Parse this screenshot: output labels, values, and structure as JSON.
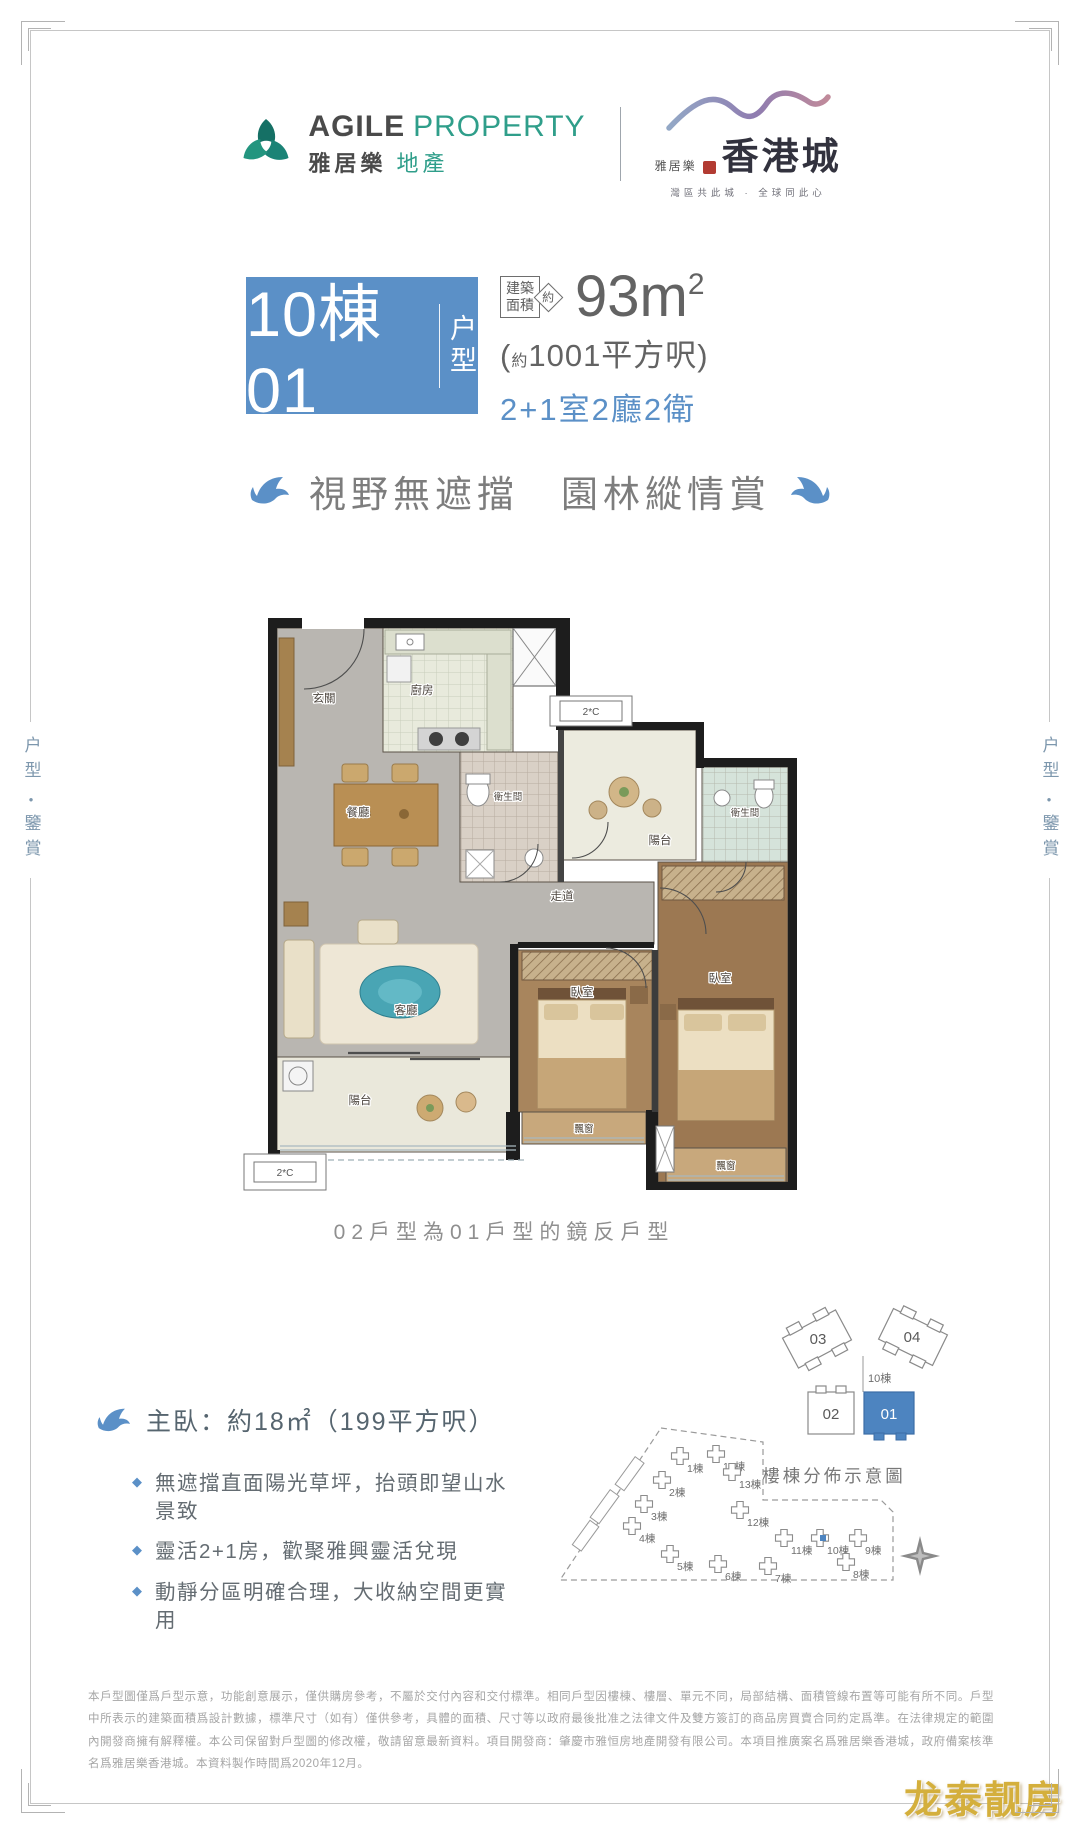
{
  "header": {
    "agile": {
      "en_bold": "AGILE",
      "en_light": "PROPERTY",
      "cn_bold": "雅居樂",
      "cn_light": "地產"
    },
    "hkcity": {
      "brand_prefix": "雅居樂",
      "brand_main": "香港城",
      "slogan": "灣區共此城 · 全球同此心"
    }
  },
  "side_label": {
    "top": "户型",
    "separator": "●",
    "bottom": "鑒賞"
  },
  "title_block": {
    "unit_number": "10棟01",
    "suffix_line1": "户",
    "suffix_line2": "型",
    "area_tag_line1": "建築",
    "area_tag_line2": "面積",
    "approx": "約",
    "area_value": "93m",
    "area_sup": "2",
    "area_hk_open": "(",
    "area_hk_approx": "約",
    "area_hk_value": "1001平方呎)",
    "layout": "2+1室2廳2衛",
    "accent_color": "#5b90c7"
  },
  "tagline": "視野無遮擋　園林縱情賞",
  "floor_plan": {
    "labels": {
      "entry": "玄關",
      "kitchen": "廚房",
      "dining": "餐廳",
      "living": "客廳",
      "corridor": "走道",
      "bath1": "衛生間",
      "bath2": "衛生間",
      "balcony_top": "陽台",
      "balcony_bottom": "陽台",
      "bedroom1": "臥室",
      "bedroom2": "臥室",
      "baywindow1": "飄窗",
      "baywindow2": "飄窗",
      "ac_unit": "2*C"
    },
    "mirror_note": "02戶型為01戶型的鏡反戶型"
  },
  "unit_cluster": {
    "tower_label": "10棟",
    "unit_03": "03",
    "unit_04": "04",
    "unit_02": "02",
    "unit_01": "01",
    "highlight_unit": "01",
    "highlight_color": "#4d84c0"
  },
  "features": {
    "headline": "主臥：約18㎡（199平方呎）",
    "bullet_glyph": "◆",
    "bullets": [
      "無遮擋直面陽光草坪，抬頭即望山水景致",
      "靈活2+1房，歡聚雅興靈活兌現",
      "動靜分區明確合理，大收納空間更實用"
    ]
  },
  "site_plan": {
    "title": "樓棟分佈示意圖",
    "highlight_building": "10棟",
    "buildings": [
      {
        "label": "1棟",
        "x": 212,
        "y": 40
      },
      {
        "label": "14棟",
        "x": 248,
        "y": 38
      },
      {
        "label": "2棟",
        "x": 194,
        "y": 64
      },
      {
        "label": "13棟",
        "x": 264,
        "y": 56
      },
      {
        "label": "3棟",
        "x": 176,
        "y": 88
      },
      {
        "label": "4棟",
        "x": 164,
        "y": 110
      },
      {
        "label": "12棟",
        "x": 272,
        "y": 94
      },
      {
        "label": "11棟",
        "x": 316,
        "y": 122
      },
      {
        "label": "10棟",
        "x": 352,
        "y": 122,
        "highlight": true
      },
      {
        "label": "9棟",
        "x": 390,
        "y": 122
      },
      {
        "label": "5棟",
        "x": 202,
        "y": 138
      },
      {
        "label": "6棟",
        "x": 250,
        "y": 148
      },
      {
        "label": "7棟",
        "x": 300,
        "y": 150
      },
      {
        "label": "8棟",
        "x": 378,
        "y": 146
      }
    ]
  },
  "disclaimer": "本戶型圖僅爲戶型示意，功能創意展示，僅供購房參考，不屬於交付內容和交付標準。相同戶型因樓棟、樓層、單元不同，局部結構、面積管線布置等可能有所不同。戶型中所表示的建築面積爲設計數據，標準尺寸（如有）僅供參考，具體的面積、尺寸等以政府最後批准之法律文件及雙方簽訂的商品房買賣合同約定爲準。在法律規定的範圍內開發商擁有解釋權。本公司保留對戶型圖的修改權，敬請留意最新資料。項目開發商：肇慶市雅恒房地產開發有限公司。本項目推廣案名爲雅居樂香港城，政府備案核準名爲雅居樂香港城。本資料製作時間爲2020年12月。",
  "watermark": "龙泰靓房"
}
